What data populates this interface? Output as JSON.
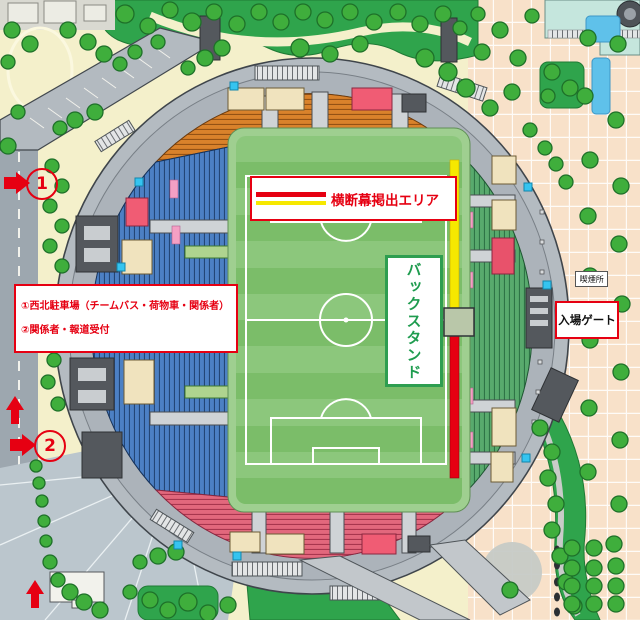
{
  "legend": {
    "banner_area_label": "横断幕掲出エリア"
  },
  "stands": {
    "back_stand_label": "バックスタンド"
  },
  "gate": {
    "label": "入場ゲート"
  },
  "smoking": {
    "label": "喫煙所"
  },
  "info_box": {
    "line1": "①西北駐車場（チームバス・荷物車・関係者）",
    "line2": "②関係者・報道受付"
  },
  "markers": {
    "m1": "1",
    "m2": "2"
  },
  "colors": {
    "accent_red": "#E60012",
    "banner_yellow": "#F6E800",
    "stand_north_orange": "#D9822B",
    "stand_west_blue": "#4C80C4",
    "stand_east_green": "#58AA6D",
    "stand_south_pink": "#E2687D",
    "pitch_green_light": "#8CC77C",
    "pitch_green_dark": "#7BBD69",
    "backstand_green": "#1F9C4F",
    "tree_green": "#3FAE3C",
    "tree_edge": "#1E7029",
    "cyan_marker": "#35C4F0",
    "plaza_peach": "#F8E1C9",
    "water_blue": "#5FC1EA"
  },
  "map": {
    "trees": [
      [
        125,
        14,
        9
      ],
      [
        148,
        26,
        8
      ],
      [
        170,
        10,
        8
      ],
      [
        192,
        22,
        9
      ],
      [
        214,
        12,
        8
      ],
      [
        237,
        24,
        8
      ],
      [
        259,
        12,
        8
      ],
      [
        281,
        22,
        8
      ],
      [
        303,
        12,
        8
      ],
      [
        325,
        20,
        8
      ],
      [
        350,
        12,
        8
      ],
      [
        374,
        22,
        8
      ],
      [
        398,
        12,
        8
      ],
      [
        420,
        24,
        8
      ],
      [
        443,
        14,
        8
      ],
      [
        460,
        28,
        7
      ],
      [
        478,
        14,
        7
      ],
      [
        300,
        48,
        9
      ],
      [
        330,
        54,
        8
      ],
      [
        360,
        44,
        8
      ],
      [
        425,
        58,
        9
      ],
      [
        448,
        72,
        9
      ],
      [
        466,
        88,
        9
      ],
      [
        482,
        52,
        8
      ],
      [
        500,
        30,
        8
      ],
      [
        518,
        58,
        8
      ],
      [
        532,
        16,
        7
      ],
      [
        512,
        92,
        8
      ],
      [
        490,
        108,
        8
      ],
      [
        205,
        58,
        8
      ],
      [
        222,
        48,
        8
      ],
      [
        188,
        68,
        7
      ],
      [
        12,
        30,
        8
      ],
      [
        30,
        44,
        8
      ],
      [
        8,
        62,
        7
      ],
      [
        68,
        30,
        8
      ],
      [
        88,
        42,
        8
      ],
      [
        104,
        54,
        8
      ],
      [
        120,
        64,
        7
      ],
      [
        95,
        112,
        8
      ],
      [
        75,
        120,
        8
      ],
      [
        18,
        112,
        7
      ],
      [
        8,
        146,
        8
      ],
      [
        60,
        128,
        7
      ],
      [
        135,
        52,
        7
      ],
      [
        158,
        42,
        7
      ],
      [
        52,
        166,
        7
      ],
      [
        62,
        186,
        7
      ],
      [
        50,
        206,
        7
      ],
      [
        62,
        226,
        7
      ],
      [
        50,
        246,
        7
      ],
      [
        62,
        266,
        7
      ],
      [
        54,
        360,
        7
      ],
      [
        48,
        382,
        7
      ],
      [
        58,
        404,
        7
      ],
      [
        36,
        466,
        6
      ],
      [
        39,
        483,
        6
      ],
      [
        42,
        501,
        6
      ],
      [
        44,
        521,
        6
      ],
      [
        46,
        541,
        6
      ],
      [
        50,
        562,
        7
      ],
      [
        58,
        580,
        7
      ],
      [
        70,
        592,
        8
      ],
      [
        84,
        602,
        8
      ],
      [
        100,
        610,
        8
      ],
      [
        150,
        600,
        8
      ],
      [
        168,
        610,
        8
      ],
      [
        188,
        602,
        9
      ],
      [
        208,
        613,
        8
      ],
      [
        228,
        605,
        8
      ],
      [
        130,
        592,
        7
      ],
      [
        140,
        562,
        7
      ],
      [
        158,
        556,
        8
      ],
      [
        176,
        552,
        8
      ],
      [
        588,
        38,
        8
      ],
      [
        618,
        44,
        8
      ],
      [
        585,
        96,
        8
      ],
      [
        616,
        120,
        8
      ],
      [
        590,
        160,
        8
      ],
      [
        621,
        186,
        8
      ],
      [
        588,
        216,
        8
      ],
      [
        619,
        244,
        8
      ],
      [
        590,
        276,
        8
      ],
      [
        622,
        304,
        8
      ],
      [
        590,
        340,
        8
      ],
      [
        621,
        372,
        8
      ],
      [
        589,
        408,
        8
      ],
      [
        620,
        440,
        8
      ],
      [
        588,
        472,
        8
      ],
      [
        619,
        504,
        8
      ],
      [
        552,
        72,
        8
      ],
      [
        570,
        88,
        8
      ],
      [
        548,
        96,
        7
      ],
      [
        530,
        130,
        7
      ],
      [
        545,
        148,
        7
      ],
      [
        556,
        164,
        7
      ],
      [
        566,
        182,
        7
      ],
      [
        540,
        428,
        8
      ],
      [
        552,
        452,
        8
      ],
      [
        548,
        478,
        8
      ],
      [
        556,
        504,
        8
      ],
      [
        552,
        530,
        8
      ],
      [
        560,
        556,
        8
      ],
      [
        566,
        582,
        8
      ],
      [
        574,
        606,
        8
      ],
      [
        572,
        548,
        8
      ],
      [
        594,
        548,
        8
      ],
      [
        614,
        544,
        8
      ],
      [
        572,
        568,
        8
      ],
      [
        594,
        568,
        8
      ],
      [
        616,
        566,
        8
      ],
      [
        572,
        586,
        8
      ],
      [
        594,
        586,
        8
      ],
      [
        616,
        586,
        8
      ],
      [
        572,
        604,
        8
      ],
      [
        594,
        604,
        8
      ],
      [
        616,
        604,
        8
      ],
      [
        510,
        590,
        8
      ]
    ],
    "cyan_markers": [
      [
        230,
        82
      ],
      [
        135,
        178
      ],
      [
        524,
        183
      ],
      [
        543,
        281
      ],
      [
        522,
        454
      ],
      [
        233,
        552
      ],
      [
        117,
        263
      ],
      [
        174,
        541
      ]
    ]
  }
}
